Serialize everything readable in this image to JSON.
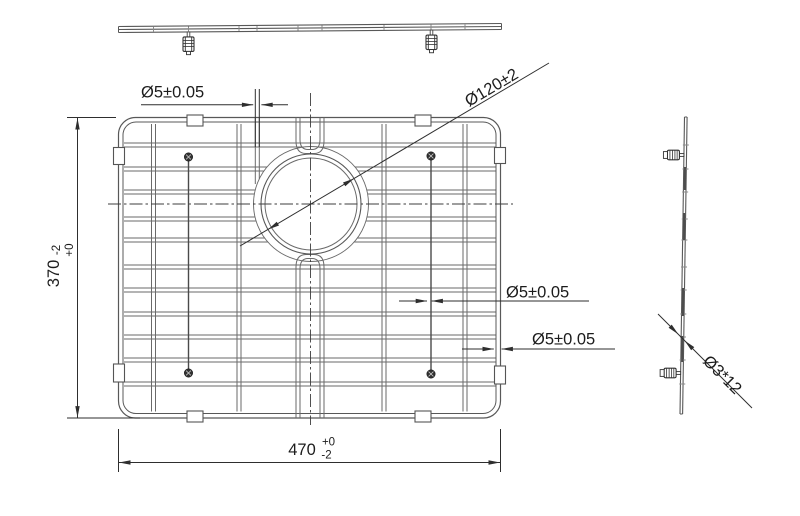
{
  "drawing": {
    "kind": "engineering-line-drawing",
    "subject": "wire sink-grid with drain opening, shown in three orthographic views",
    "background": "#ffffff"
  },
  "labels": {
    "dim_wire_top": "Ø5±0.05",
    "dim_hole": "Ø120±2",
    "dim_wire_mid": "Ø5±0.05",
    "dim_wire_frame": "Ø5±0.05",
    "dim_height_value": "370",
    "dim_height_tol_plus": "+0",
    "dim_height_tol_minus": "-2",
    "dim_width_value": "470",
    "dim_width_tol_plus": "+0",
    "dim_width_tol_minus": "-2",
    "dim_foot": "Ø3*12"
  },
  "colors": {
    "wire": "#6a6a6a",
    "frame": "#585858",
    "dim": "#2e2e2e",
    "dark": "#3a3a3a",
    "text": "#1c1c1c",
    "white": "#ffffff"
  },
  "geometry": {
    "frame": {
      "x": 118.5,
      "y": 117.5,
      "w": 382,
      "h": 300.5,
      "rx": 17,
      "inset": 4.5,
      "irx": 13
    },
    "wire_gap": 4,
    "rows_y": [
      143,
      167,
      190,
      217,
      238,
      265,
      288,
      312,
      335,
      358,
      382
    ],
    "cols_x": [
      151.5,
      237,
      382,
      463
    ],
    "short_col": {
      "x": 255.3,
      "y1": 118,
      "y2": 184
    },
    "center_cols": {
      "xo1": 296,
      "xi1": 300,
      "xi2": 320,
      "xo2": 324,
      "top_bend": 153.5,
      "bot_bend": 254.5
    },
    "hole": {
      "cx": 311,
      "cy": 204,
      "r_outer": 50,
      "r_inner": 46,
      "r_clear": 57.5
    },
    "centerline_h": {
      "y": 204,
      "x1": 108,
      "x2": 513
    },
    "centerline_v": {
      "x": 310.5,
      "y1": 93,
      "y2": 425
    },
    "screws": [
      [
        188.5,
        157
      ],
      [
        431,
        156
      ],
      [
        188.5,
        373
      ],
      [
        431,
        374
      ]
    ],
    "screw_wires": [
      [
        188.5,
        160,
        370
      ],
      [
        431,
        159,
        371
      ]
    ],
    "tabs": [
      [
        187,
        115,
        16,
        11
      ],
      [
        415,
        115,
        16,
        11
      ],
      [
        187,
        411,
        16,
        11
      ],
      [
        415,
        411,
        16,
        11
      ],
      [
        113.5,
        147.5,
        11,
        17
      ],
      [
        113.5,
        364,
        11,
        18
      ],
      [
        494.5,
        147.5,
        11,
        16
      ],
      [
        494.5,
        366,
        11,
        18
      ]
    ],
    "top_view": {
      "x1": 118.5,
      "x2": 501.5,
      "y_left": 26.5,
      "y_right": 23.5,
      "line_gap": 3,
      "ticks": [
        153.5,
        188.5,
        239,
        257,
        298,
        322,
        384,
        431,
        465
      ],
      "feet_x": [
        188.5,
        431.5
      ]
    },
    "side_view": {
      "top_x": 684.5,
      "top_y": 117,
      "bot_x": 680,
      "bot_y": 414,
      "width": 2.6,
      "tick_rows": [
        145,
        169,
        192,
        219,
        240,
        267,
        290,
        314,
        337,
        360,
        384
      ],
      "strips": [
        [
          167,
          190
        ],
        [
          213,
          240
        ],
        [
          288,
          316
        ],
        [
          336,
          362
        ]
      ],
      "feet_y": [
        155,
        373
      ]
    },
    "dim_lines": [
      [
        141,
        104.8,
        253.2,
        104.8
      ],
      [
        261.4,
        104.8,
        288,
        104.8
      ],
      [
        255.3,
        89,
        255.3,
        147
      ],
      [
        259.3,
        89,
        259.3,
        147
      ],
      [
        240,
        246,
        549,
        63
      ],
      [
        399,
        301,
        427,
        301
      ],
      [
        431.6,
        301,
        589,
        301
      ],
      [
        462,
        349,
        493.8,
        349
      ],
      [
        501.6,
        349,
        615,
        349
      ],
      [
        67,
        117.5,
        116,
        117.5
      ],
      [
        67,
        418,
        140,
        418
      ],
      [
        77.5,
        117.5,
        77.5,
        418
      ],
      [
        658,
        314,
        752,
        408
      ],
      [
        118.5,
        429,
        118.5,
        472
      ],
      [
        500.5,
        429,
        500.5,
        472
      ],
      [
        118.5,
        462.5,
        500.5,
        462.5
      ]
    ],
    "dim_arrows": [
      [
        253.4,
        104.8,
        0
      ],
      [
        261.2,
        104.8,
        180
      ],
      [
        268,
        229.5,
        149
      ],
      [
        354,
        178.5,
        -31
      ],
      [
        427.2,
        301,
        0
      ],
      [
        431.4,
        301,
        180
      ],
      [
        494,
        349,
        0
      ],
      [
        501.4,
        349,
        180
      ],
      [
        77.5,
        118,
        -90
      ],
      [
        77.5,
        417.6,
        90
      ],
      [
        678.3,
        334.3,
        45
      ],
      [
        684.6,
        340.6,
        225
      ],
      [
        119,
        462.5,
        180
      ],
      [
        500,
        462.5,
        0
      ]
    ]
  }
}
